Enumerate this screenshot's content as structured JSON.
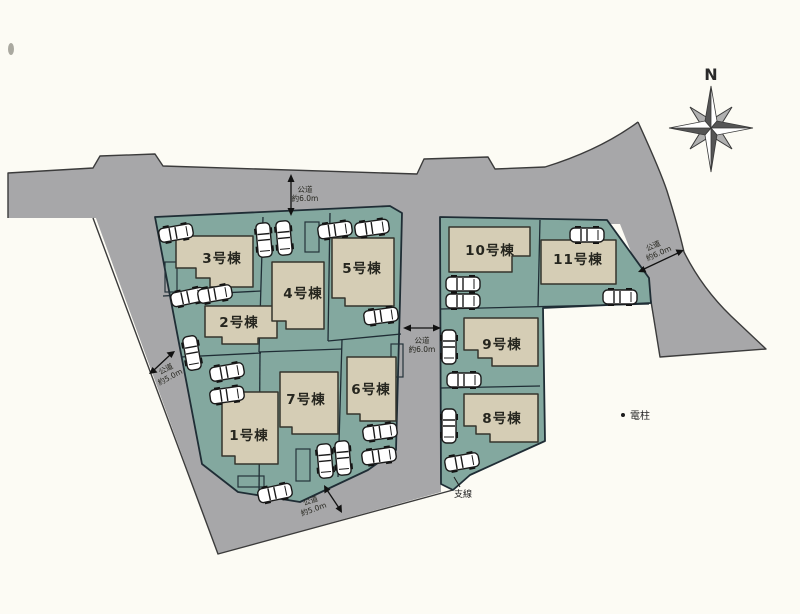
{
  "colors": {
    "background": "#fcfbf4",
    "road": "#a7a7a9",
    "lot": "#83a89f",
    "building": "#d5cdb5",
    "outline": "#1f2d35",
    "text": "#26261f"
  },
  "compass": {
    "north_label": "N"
  },
  "lots": [
    {
      "label": "1号棟"
    },
    {
      "label": "2号棟"
    },
    {
      "label": "3号棟"
    },
    {
      "label": "4号棟"
    },
    {
      "label": "5号棟"
    },
    {
      "label": "6号棟"
    },
    {
      "label": "7号棟"
    },
    {
      "label": "8号棟"
    },
    {
      "label": "9号棟"
    },
    {
      "label": "10号棟"
    },
    {
      "label": "11号棟"
    }
  ],
  "road_labels": {
    "top": {
      "line1": "公道",
      "line2": "約6.0m"
    },
    "left": {
      "line1": "公道",
      "line2": "約5.0m"
    },
    "center": {
      "line1": "公道",
      "line2": "約6.0m"
    },
    "bottom": {
      "line1": "公道",
      "line2": "約5.0m"
    },
    "right": {
      "line1": "公道",
      "line2": "約6.0m"
    }
  },
  "annotations": {
    "support_line": "支線",
    "utility_pole": "電柱"
  },
  "icons": {
    "compass": "compass-rose-icon",
    "car": "car-icon",
    "pole": "utility-pole-dot"
  }
}
